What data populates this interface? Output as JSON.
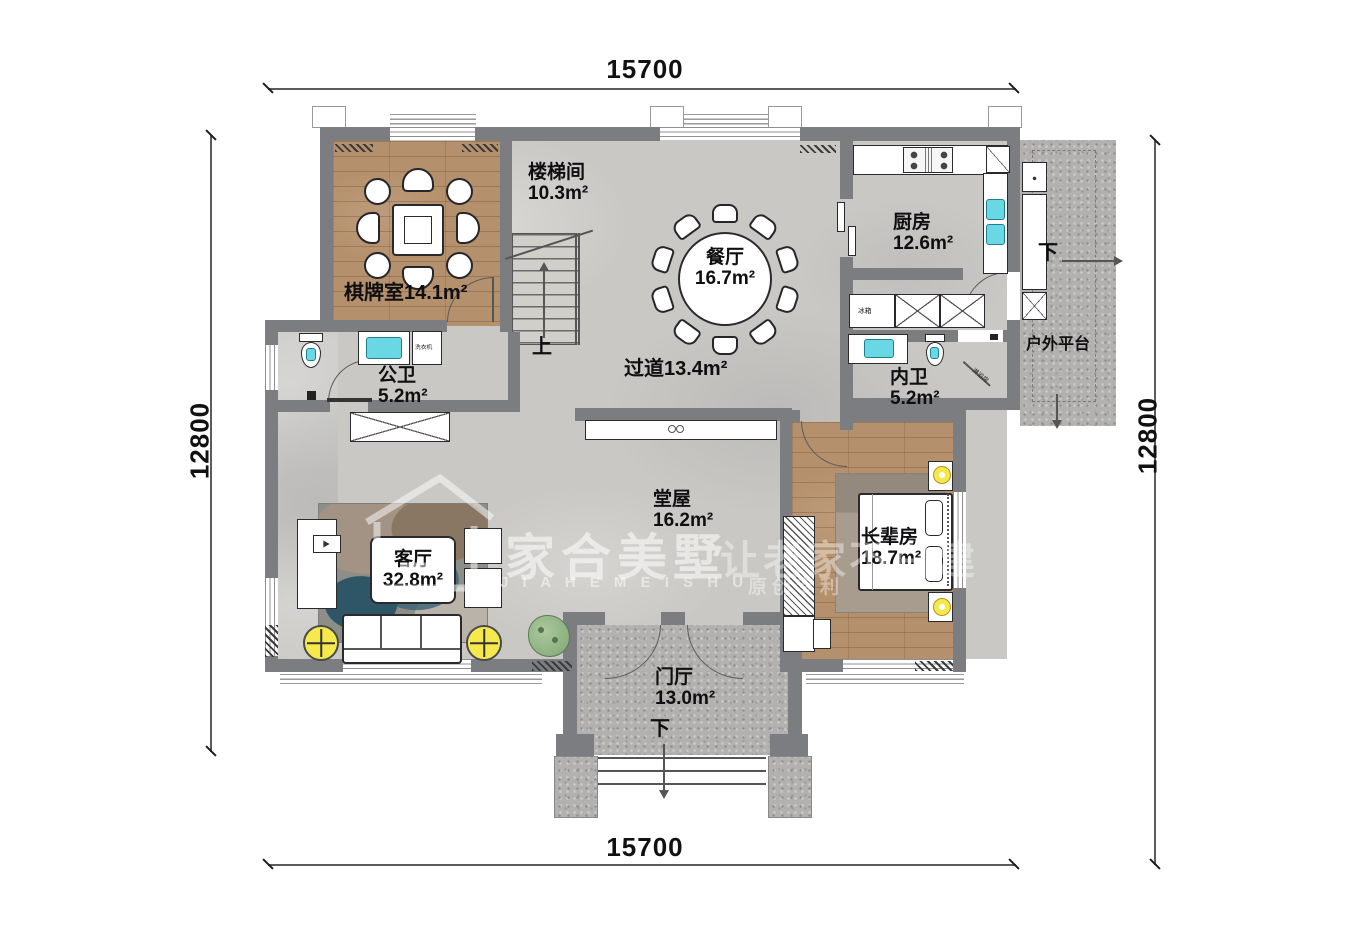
{
  "dimensions": {
    "top": "15700",
    "bottom": "15700",
    "left": "12800",
    "right": "12800"
  },
  "rooms": [
    {
      "name": "棋牌室",
      "area": "14.1m²"
    },
    {
      "name": "楼梯间",
      "area": "10.3m²"
    },
    {
      "name": "餐厅",
      "area": "16.7m²"
    },
    {
      "name": "厨房",
      "area": "12.6m²"
    },
    {
      "name": "公卫",
      "area": "5.2m²"
    },
    {
      "name": "内卫",
      "area": "5.2m²"
    },
    {
      "name": "过道",
      "area": "13.4m²"
    },
    {
      "name": "堂屋",
      "area": "16.2m²"
    },
    {
      "name": "客厅",
      "area": "32.8m²"
    },
    {
      "name": "长辈房",
      "area": "18.7m²"
    },
    {
      "name": "门厅",
      "area": "13.0m²"
    },
    {
      "name": "户外平台",
      "area": ""
    }
  ],
  "annotations": {
    "up": "上",
    "down": "下",
    "washing_machine": "洗衣机",
    "fridge": "冰箱",
    "shower_room": "淋浴房"
  },
  "watermark": {
    "brand": "家合美墅",
    "slogan": "让老家不白建",
    "latin": "J I A H E M E I S H U",
    "sub": "原创专利"
  },
  "colors": {
    "wall": "#7b7d80",
    "wood_floor": "#b5906c",
    "tile_floor": "#c9c8c5",
    "granite": "#b2b1af",
    "sink_cyan": "#69d8e4",
    "accent_yellow": "#f6e94e",
    "plant_green": "#7fa674"
  }
}
